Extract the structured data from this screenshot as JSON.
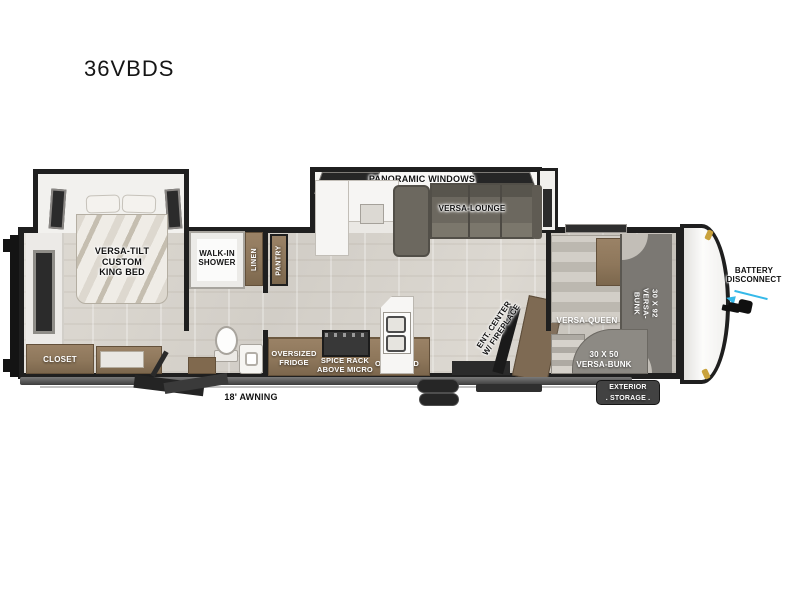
{
  "title": "36VBDS",
  "colors": {
    "wall": "#1f1f1f",
    "cabinet": "#8e775b",
    "cabinet_dark": "#80694e",
    "sofa": "#6c685f",
    "bunk_gray": "#7b7873",
    "floor": "#d6d2cb",
    "arrow_accent": "#35b9e9",
    "marker_gold": "#c9a23d",
    "badge_bg": "#424242"
  },
  "exterior": {
    "awning_label": "18' AWNING",
    "battery_label": "BATTERY\nDISCONNECT",
    "storage_label": "EXTERIOR\n. STORAGE ."
  },
  "living": {
    "panoramic_label": "PANORAMIC WINDOWS",
    "lounge_label": "VERSA-LOUNGE",
    "ent_label": "ENT. CENTER\nW/ FIREPLACE"
  },
  "kitchen": {
    "fridge_label": "OVERSIZED\nFRIDGE",
    "spice_label": "SPICE RACK\nABOVE MICRO",
    "overhead_label": "OVERHEAD",
    "pantry_label": "PANTRY"
  },
  "bedroom": {
    "bed_label": "VERSA-TILT\nCUSTOM\nKING BED",
    "closet_label": "CLOSET"
  },
  "bathroom": {
    "shower_label": "WALK-IN\nSHOWER",
    "linen_label": "LINEN"
  },
  "bunkroom": {
    "queen_label": "VERSA-QUEEN",
    "bunk_30x92_label": "30 X 92\nVERSA-BUNK",
    "bunk_30x50_label": "30 X 50\nVERSA-BUNK"
  }
}
